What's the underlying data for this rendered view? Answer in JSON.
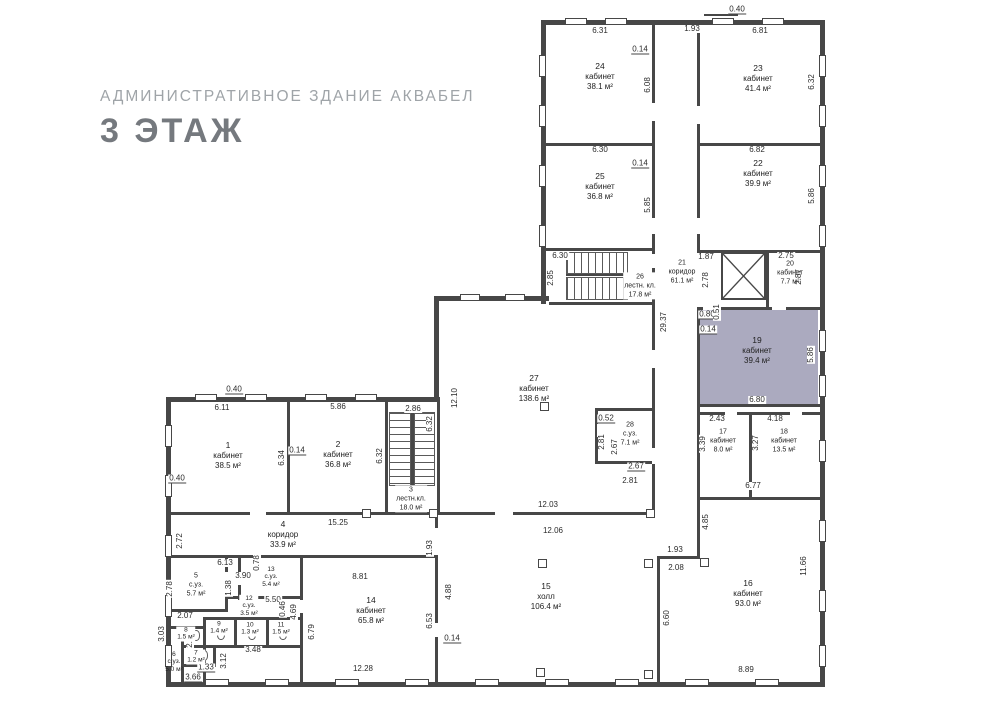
{
  "title": {
    "subtitle": "АДМИНИСТРАТИВНОЕ ЗДАНИЕ АКВАБЕЛ",
    "floor": "3 ЭТАЖ"
  },
  "colors": {
    "highlight": "#a7a5bc",
    "wall": "#474747",
    "floor_title": "#75797e",
    "subtitle_gray": "#9fa4a8"
  },
  "rooms": [
    {
      "num": "1",
      "name": "кабинет",
      "area": "38.5 м²"
    },
    {
      "num": "2",
      "name": "кабинет",
      "area": "36.8 м²"
    },
    {
      "num": "3",
      "name": "лестн.кл.",
      "area": "18.0 м²"
    },
    {
      "num": "4",
      "name": "коридор",
      "area": "33.9 м²"
    },
    {
      "num": "5",
      "name": "с.уз.",
      "area": "5.7 м²"
    },
    {
      "num": "6",
      "name": "с.уз.",
      "area": "5.0 м²"
    },
    {
      "num": "7",
      "name": "",
      "area": "1.2 м²"
    },
    {
      "num": "8",
      "name": "",
      "area": "1.5 м²"
    },
    {
      "num": "9",
      "name": "",
      "area": "1.4 м²"
    },
    {
      "num": "10",
      "name": "",
      "area": "1.3 м²"
    },
    {
      "num": "11",
      "name": "",
      "area": "1.5 м²"
    },
    {
      "num": "12",
      "name": "с.уз.",
      "area": "3.5 м²"
    },
    {
      "num": "13",
      "name": "с.уз.",
      "area": "5.4 м²"
    },
    {
      "num": "14",
      "name": "кабинет",
      "area": "65.8 м²"
    },
    {
      "num": "15",
      "name": "холл",
      "area": "106.4 м²"
    },
    {
      "num": "16",
      "name": "кабинет",
      "area": "93.0 м²"
    },
    {
      "num": "17",
      "name": "кабинет",
      "area": "8.0 м²"
    },
    {
      "num": "18",
      "name": "кабинет",
      "area": "13.5 м²"
    },
    {
      "num": "19",
      "name": "кабинет",
      "area": "39.4 м²"
    },
    {
      "num": "20",
      "name": "кабинет",
      "area": "7.7 м²"
    },
    {
      "num": "21",
      "name": "коридор",
      "area": "61.1 м²"
    },
    {
      "num": "22",
      "name": "кабинет",
      "area": "39.9 м²"
    },
    {
      "num": "23",
      "name": "кабинет",
      "area": "41.4 м²"
    },
    {
      "num": "24",
      "name": "кабинет",
      "area": "38.1 м²"
    },
    {
      "num": "25",
      "name": "кабинет",
      "area": "36.8 м²"
    },
    {
      "num": "26",
      "name": "лестн. кл.",
      "area": "17.8 м²"
    },
    {
      "num": "27",
      "name": "кабинет",
      "area": "138.6 м²"
    },
    {
      "num": "28",
      "name": "с.уз.",
      "area": "7.1 м²"
    }
  ],
  "dims": [
    "0.40",
    "6.31",
    "1.93",
    "6.81",
    "0.14",
    "6.08",
    "6.32",
    "6.30",
    "0.14",
    "6.82",
    "5.85",
    "5.86",
    "6.30",
    "2.85",
    "1.87",
    "2.75",
    "2.78",
    "2.87",
    "29.37",
    "0.80",
    "0.51",
    "0.14",
    "5.86",
    "6.80",
    "2.43",
    "4.18",
    "3.39",
    "3.27",
    "6.77",
    "4.85",
    "11.66",
    "8.89",
    "0.40",
    "6.11",
    "5.86",
    "2.86",
    "6.32",
    "12.10",
    "0.14",
    "6.34",
    "6.32",
    "0.40",
    "12.03",
    "12.06",
    "0.52",
    "2.81",
    "2.67",
    "2.67",
    "2.81",
    "15.25",
    "2.72",
    "1.93",
    "6.13",
    "0.78",
    "3.90",
    "1.38",
    "5.50",
    "0.46",
    "4.69",
    "2.07",
    "2.78",
    "2.20",
    "3.03",
    "1.33",
    "3.66",
    "3.48",
    "3.12",
    "6.79",
    "8.81",
    "12.28",
    "6.53",
    "4.88",
    "0.14",
    "1.93",
    "2.08",
    "6.60"
  ]
}
